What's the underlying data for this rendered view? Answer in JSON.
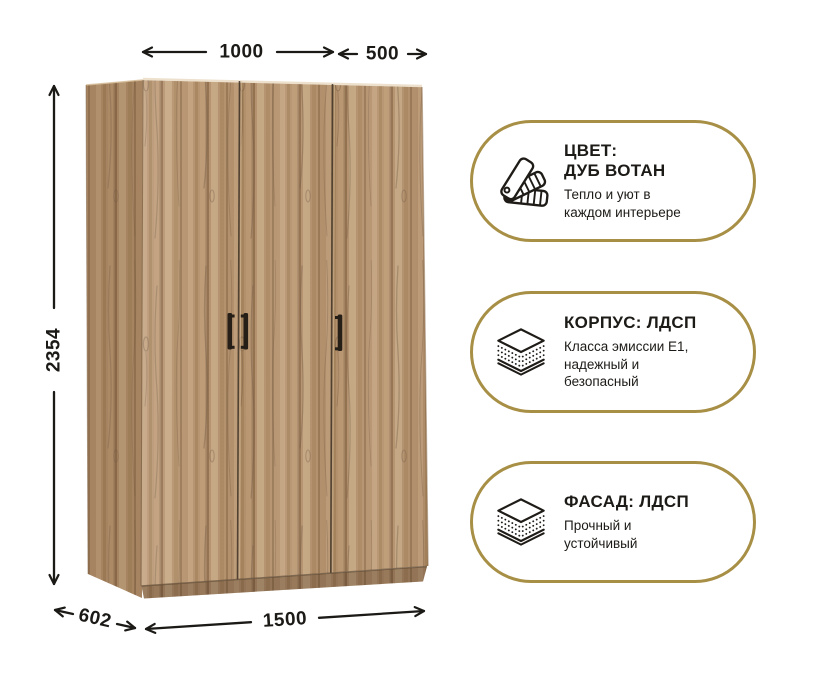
{
  "colors": {
    "accent_gold": "#a88f46",
    "text_dark": "#1d1b17",
    "dimension_line": "#1c1a17",
    "wood_base": "#b6936f",
    "wood_dark_streak": "#93714f",
    "wood_light_streak": "#c6a883",
    "handle_black": "#251f18"
  },
  "dimensions": {
    "top_left_width": "1000",
    "top_right_width": "500",
    "height": "2354",
    "depth": "602",
    "total_width": "1500"
  },
  "badges": [
    {
      "id": "color",
      "icon": "color-swatch-fan-icon",
      "title": "ЦВЕТ:\nДУБ ВОТАН",
      "subtitle": "Тепло и уют в\nкаждом интерьере"
    },
    {
      "id": "body",
      "icon": "laminated-board-icon",
      "title": "КОРПУС: ЛДСП",
      "subtitle": "Класса эмиссии Е1,\nнадежный и\nбезопасный"
    },
    {
      "id": "facade",
      "icon": "laminated-board-icon",
      "title": "ФАСАД: ЛДСП",
      "subtitle": "Прочный и\nустойчивый"
    }
  ]
}
